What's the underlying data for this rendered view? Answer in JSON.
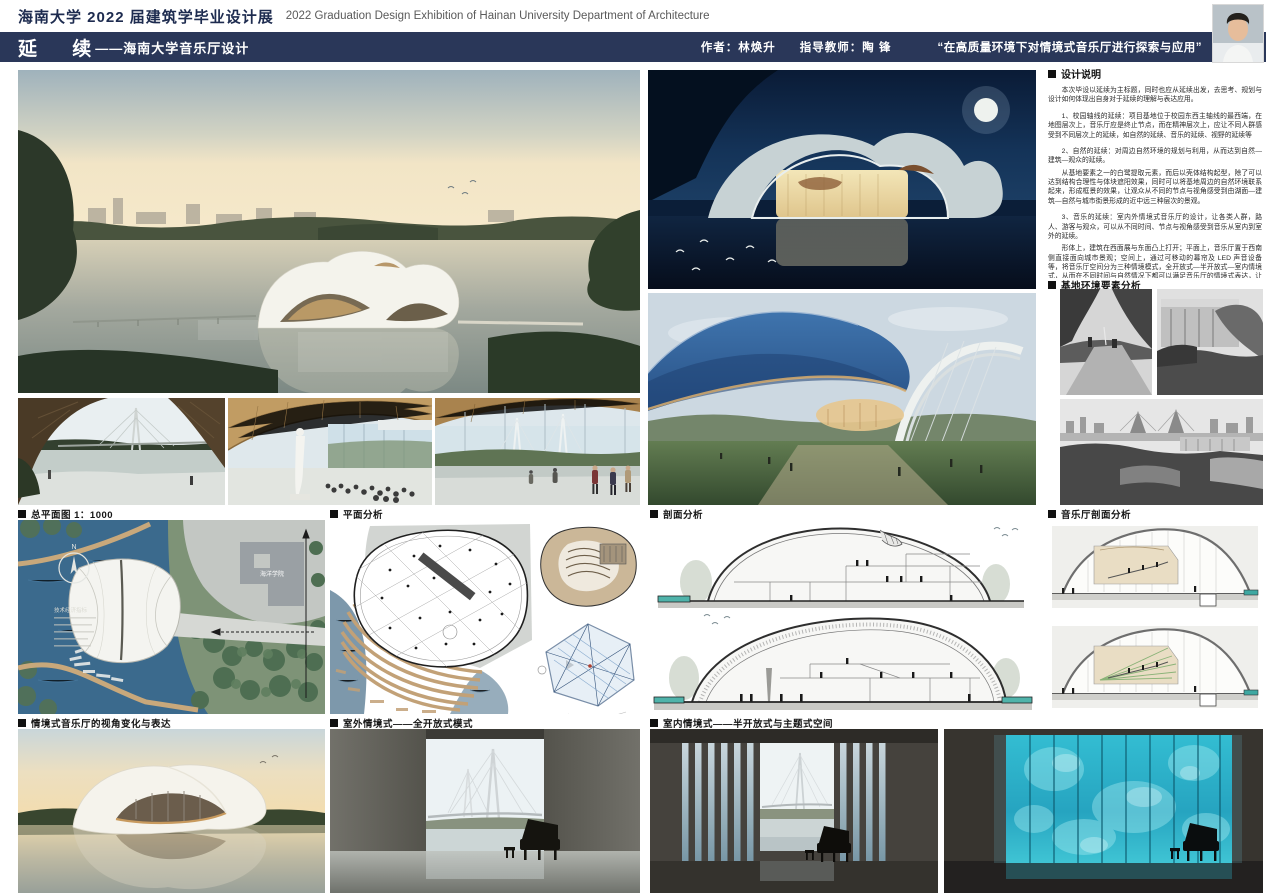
{
  "palette": {
    "navy": "#2a3759",
    "header_text_navy": "#1d2b4f",
    "label_black": "#141414",
    "teal_led": "#35c2d8",
    "canopy_blue": "#2f5d95",
    "section_water_teal": "#4fb3aa"
  },
  "header": {
    "title_cn": "海南大学 2022 届建筑学毕业设计展",
    "title_en": "2022 Graduation Design Exhibition of Hainan University Department of Architecture"
  },
  "titlebar": {
    "title": "延 续",
    "subtitle": "——海南大学音乐厅设计",
    "author": "作者：林焕升",
    "advisor": "指导教师：陶 锋",
    "quote": "“在高质量环境下对情境式音乐厅进行探索与应用”"
  },
  "design_notes": {
    "heading": "设计说明",
    "paragraphs": [
      "本次毕设以延续为主标题，同时也应从延续出发，去思考、规划与设计如何体现出自身对于延续的理解与表达应用。",
      "1、校园轴线的延续：项目基地位于校园东西主轴线的最西端，在地图层次上，音乐厅应是终止节点，而在精神层次上，应让不同人群感受到不同层次上的延续，如自然的延续、音乐的延续、视野的延续等",
      "2、自然的延续：对周边自然环境的规划与利用，从而达到自然—建筑—观众的延续。",
      "从基地要素之一的白鹭提取元素，而后以壳体结构起型，除了可以达到结构合理性与体块遮阳效果，同时可以将基地周边的自然环境联系起来，形成框景的效果，让观众从不同的节点与视角感受到由湖面—建筑—自然与城市街景形成的近中远三种层次的景观。",
      "3、音乐的延续：室内外情境式音乐厅的设计，让各类人群，路人、游客与观众，可以从不同时间、节点与视角感受到音乐从室内到室外的延续。",
      "形体上，建筑在西面展与东面凸上打开；平面上，音乐厅置于西南侧直接面向城市景观；空间上，通过可移动的幕帘及 LED 声音设备等，将音乐厅空间分为三种情境模式，全开放式—半开放式—室内情境式，从而在不同时间与自然情况下都可以满足音乐厅的情境式表达，让人们在不同节点与视角感受到音乐从室内到室外的延续。",
      "总的来说，从城市—建筑—人群的整体关系入手，通过对延续的理解，进行上述三点从物质到精神层次上的延续的空间与表达，完成了对空间规划，而后通过合适的结构体系—壳体结构与空间结合，完成了建筑从内到外体系的完全确定，从而在空间与形体上，和谐统一且满足各类人群的需求，从而完成对延续标题的表达。"
    ]
  },
  "sections": {
    "site_plan": "总平面图 1：1000",
    "plan_analysis": "平面分析",
    "section_analysis": "剖面分析",
    "hall_section": "音乐厅剖面分析",
    "site_env": "基地环境要素分析",
    "perspective": "情境式音乐厅的视角变化与表达",
    "outdoor_mode": "室外情境式——全开放式模式",
    "indoor_mode": "室内情境式——半开放式与主题式空间"
  },
  "site_plan": {
    "compass": "N",
    "indicators_title": "技术经济指标",
    "campus_building_label": "海洋学院"
  }
}
